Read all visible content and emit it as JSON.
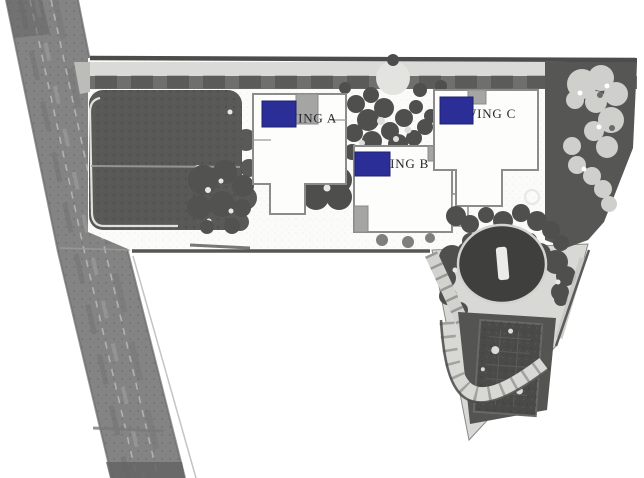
{
  "site_plan": {
    "wings": [
      {
        "id": "wing-a",
        "label": "WING A"
      },
      {
        "id": "wing-b",
        "label": "WING B"
      },
      {
        "id": "wing-c",
        "label": "WING C"
      }
    ],
    "colors": {
      "marker": "#2b2e96",
      "label_text": "#26262c",
      "road": "#848484",
      "dark_landscape": "#565654",
      "light_paving": "#d8d8d5",
      "background": "#ffffff"
    }
  }
}
